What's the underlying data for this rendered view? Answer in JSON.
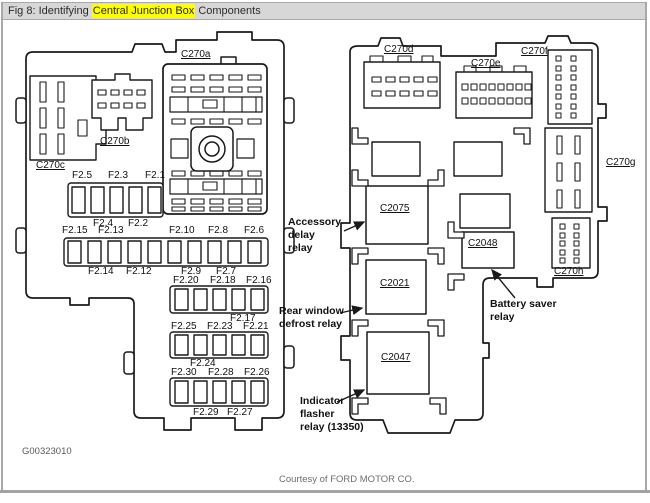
{
  "window": {
    "title_prefix": "Fig 8: Identifying ",
    "title_highlight": "Central Junction Box",
    "title_suffix": " Components"
  },
  "left_view": {
    "connector_labels": {
      "c270a": "C270a",
      "c270b": "C270b",
      "c270c": "C270c"
    },
    "fuse_labels": {
      "row1_top": [
        "F2.5",
        "F2.3",
        "F2.1"
      ],
      "row1_bottom": [
        "F2.4",
        "F2.2"
      ],
      "row2_top": [
        "F2.15",
        "F2.13",
        "F2.10",
        "F2.8",
        "F2.6"
      ],
      "row2_bottom": [
        "F2.14",
        "F2.12",
        "F2.9",
        "F2.7"
      ],
      "row3_top": [
        "F2.20",
        "F2.18",
        "F2.16"
      ],
      "row3_bottom": [
        "F2.17"
      ],
      "row4_top": [
        "F2.25",
        "F2.23",
        "F2.21"
      ],
      "row4_bottom": [
        "F2.24"
      ],
      "row5_top": [
        "F2.30",
        "F2.28",
        "F2.26"
      ],
      "row5_bottom": [
        "F2.29",
        "F2.27"
      ]
    }
  },
  "right_view": {
    "connector_labels": {
      "c270d": "C270d",
      "c270e": "C270e",
      "c270f": "C270f",
      "c270g": "C270g",
      "c270h": "C270h"
    },
    "relay_labels": {
      "c2075": "C2075",
      "c2021": "C2021",
      "c2047": "C2047",
      "c2048": "C2048"
    },
    "annotations": {
      "accessory": "Accessory\ndelay\nrelay",
      "rear_window": "Rear window\ndefrost relay",
      "battery_saver": "Battery saver\nrelay",
      "indicator_flasher": "Indicator\nflasher\nrelay (13350)"
    }
  },
  "footer": {
    "figure_code": "G00323010",
    "credit": "Courtesy of FORD MOTOR CO."
  },
  "colors": {
    "highlight": "#ffff00",
    "line": "#1a1a1a",
    "titlebar_bg": "#d7d7d7"
  }
}
